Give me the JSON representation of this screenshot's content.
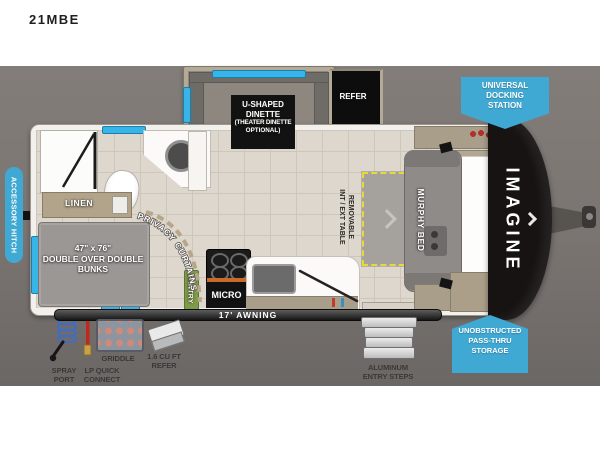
{
  "title": "21MBE",
  "colors": {
    "badge_blue": "#3fa9d4",
    "window_blue": "#38b5e8",
    "pantry_green": "#7f9b4a",
    "table_dash_yellow": "#e8d83a",
    "backdrop_gray": "#7b7572",
    "cap_black": "#161312"
  },
  "floorplan": {
    "brand_logo": "IMAGINE",
    "awning": "17' AWNING",
    "rooms": {
      "dinette": {
        "line1": "U-SHAPED",
        "line2": "DINETTE",
        "line3": "(THEATER DINETTE",
        "line4": "OPTIONAL)"
      },
      "refer": "REFER",
      "linen": "LINEN",
      "bunks": {
        "line1": "47\" x 76\"",
        "line2": "DOUBLE OVER DOUBLE",
        "line3": "BUNKS"
      },
      "privacy_curtains": "PRIVACY CURTAINS",
      "pantry": "PANTRY",
      "micro": "MICRO",
      "murphy_bed": "MURPHY BED",
      "table": {
        "line1": "REMOVABLE",
        "line2": "INT / EXT TABLE"
      }
    },
    "badges": {
      "accessory_hitch": "ACCESSORY HITCH",
      "docking": {
        "line1": "UNIVERSAL",
        "line2": "DOCKING",
        "line3": "STATION"
      },
      "storage": {
        "line1": "UNOBSTRUCTED",
        "line2": "PASS-THRU",
        "line3": "STORAGE"
      }
    },
    "exterior_features": {
      "spray_port": {
        "line1": "SPRAY",
        "line2": "PORT"
      },
      "lp": {
        "line1": "LP QUICK",
        "line2": "CONNECT"
      },
      "griddle": "GRIDDLE",
      "mini_refer": {
        "line1": "1.6 CU FT",
        "line2": "REFER"
      },
      "steps": {
        "line1": "ALUMINUM",
        "line2": "ENTRY STEPS"
      }
    }
  }
}
